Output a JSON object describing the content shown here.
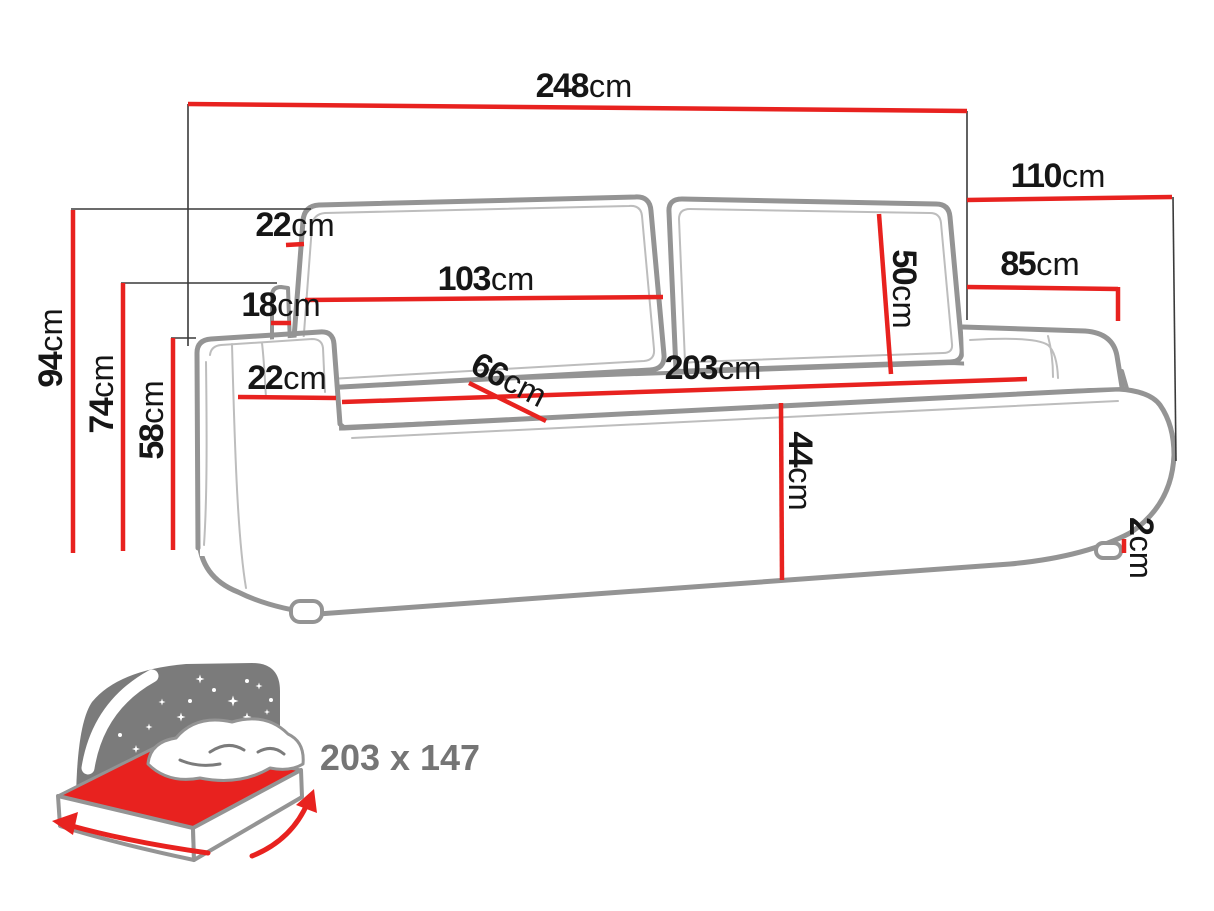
{
  "colors": {
    "dimension_red": "#e8221f",
    "sofa_outline_gray": "#949494",
    "label_text": "#161616",
    "icon_gray": "#7b7b7b"
  },
  "dimensions": {
    "overall_width": {
      "value": "248",
      "unit": "cm"
    },
    "overall_depth": {
      "value": "110",
      "unit": "cm"
    },
    "armrest_depth": {
      "value": "85",
      "unit": "cm"
    },
    "back_cushion_height": {
      "value": "50",
      "unit": "cm"
    },
    "back_cushion_width": {
      "value": "103",
      "unit": "cm"
    },
    "back_cushion_thickness": {
      "value": "22",
      "unit": "cm"
    },
    "back_frame_thickness": {
      "value": "18",
      "unit": "cm"
    },
    "armrest_width": {
      "value": "22",
      "unit": "cm"
    },
    "seat_depth": {
      "value": "66",
      "unit": "cm"
    },
    "seat_width": {
      "value": "203",
      "unit": "cm"
    },
    "seat_height": {
      "value": "44",
      "unit": "cm"
    },
    "leg_height": {
      "value": "2",
      "unit": "cm"
    },
    "overall_height": {
      "value": "94",
      "unit": "cm"
    },
    "backrest_height": {
      "value": "74",
      "unit": "cm"
    },
    "armrest_height": {
      "value": "58",
      "unit": "cm"
    }
  },
  "sleeping_area": {
    "label": "203 x 147"
  }
}
